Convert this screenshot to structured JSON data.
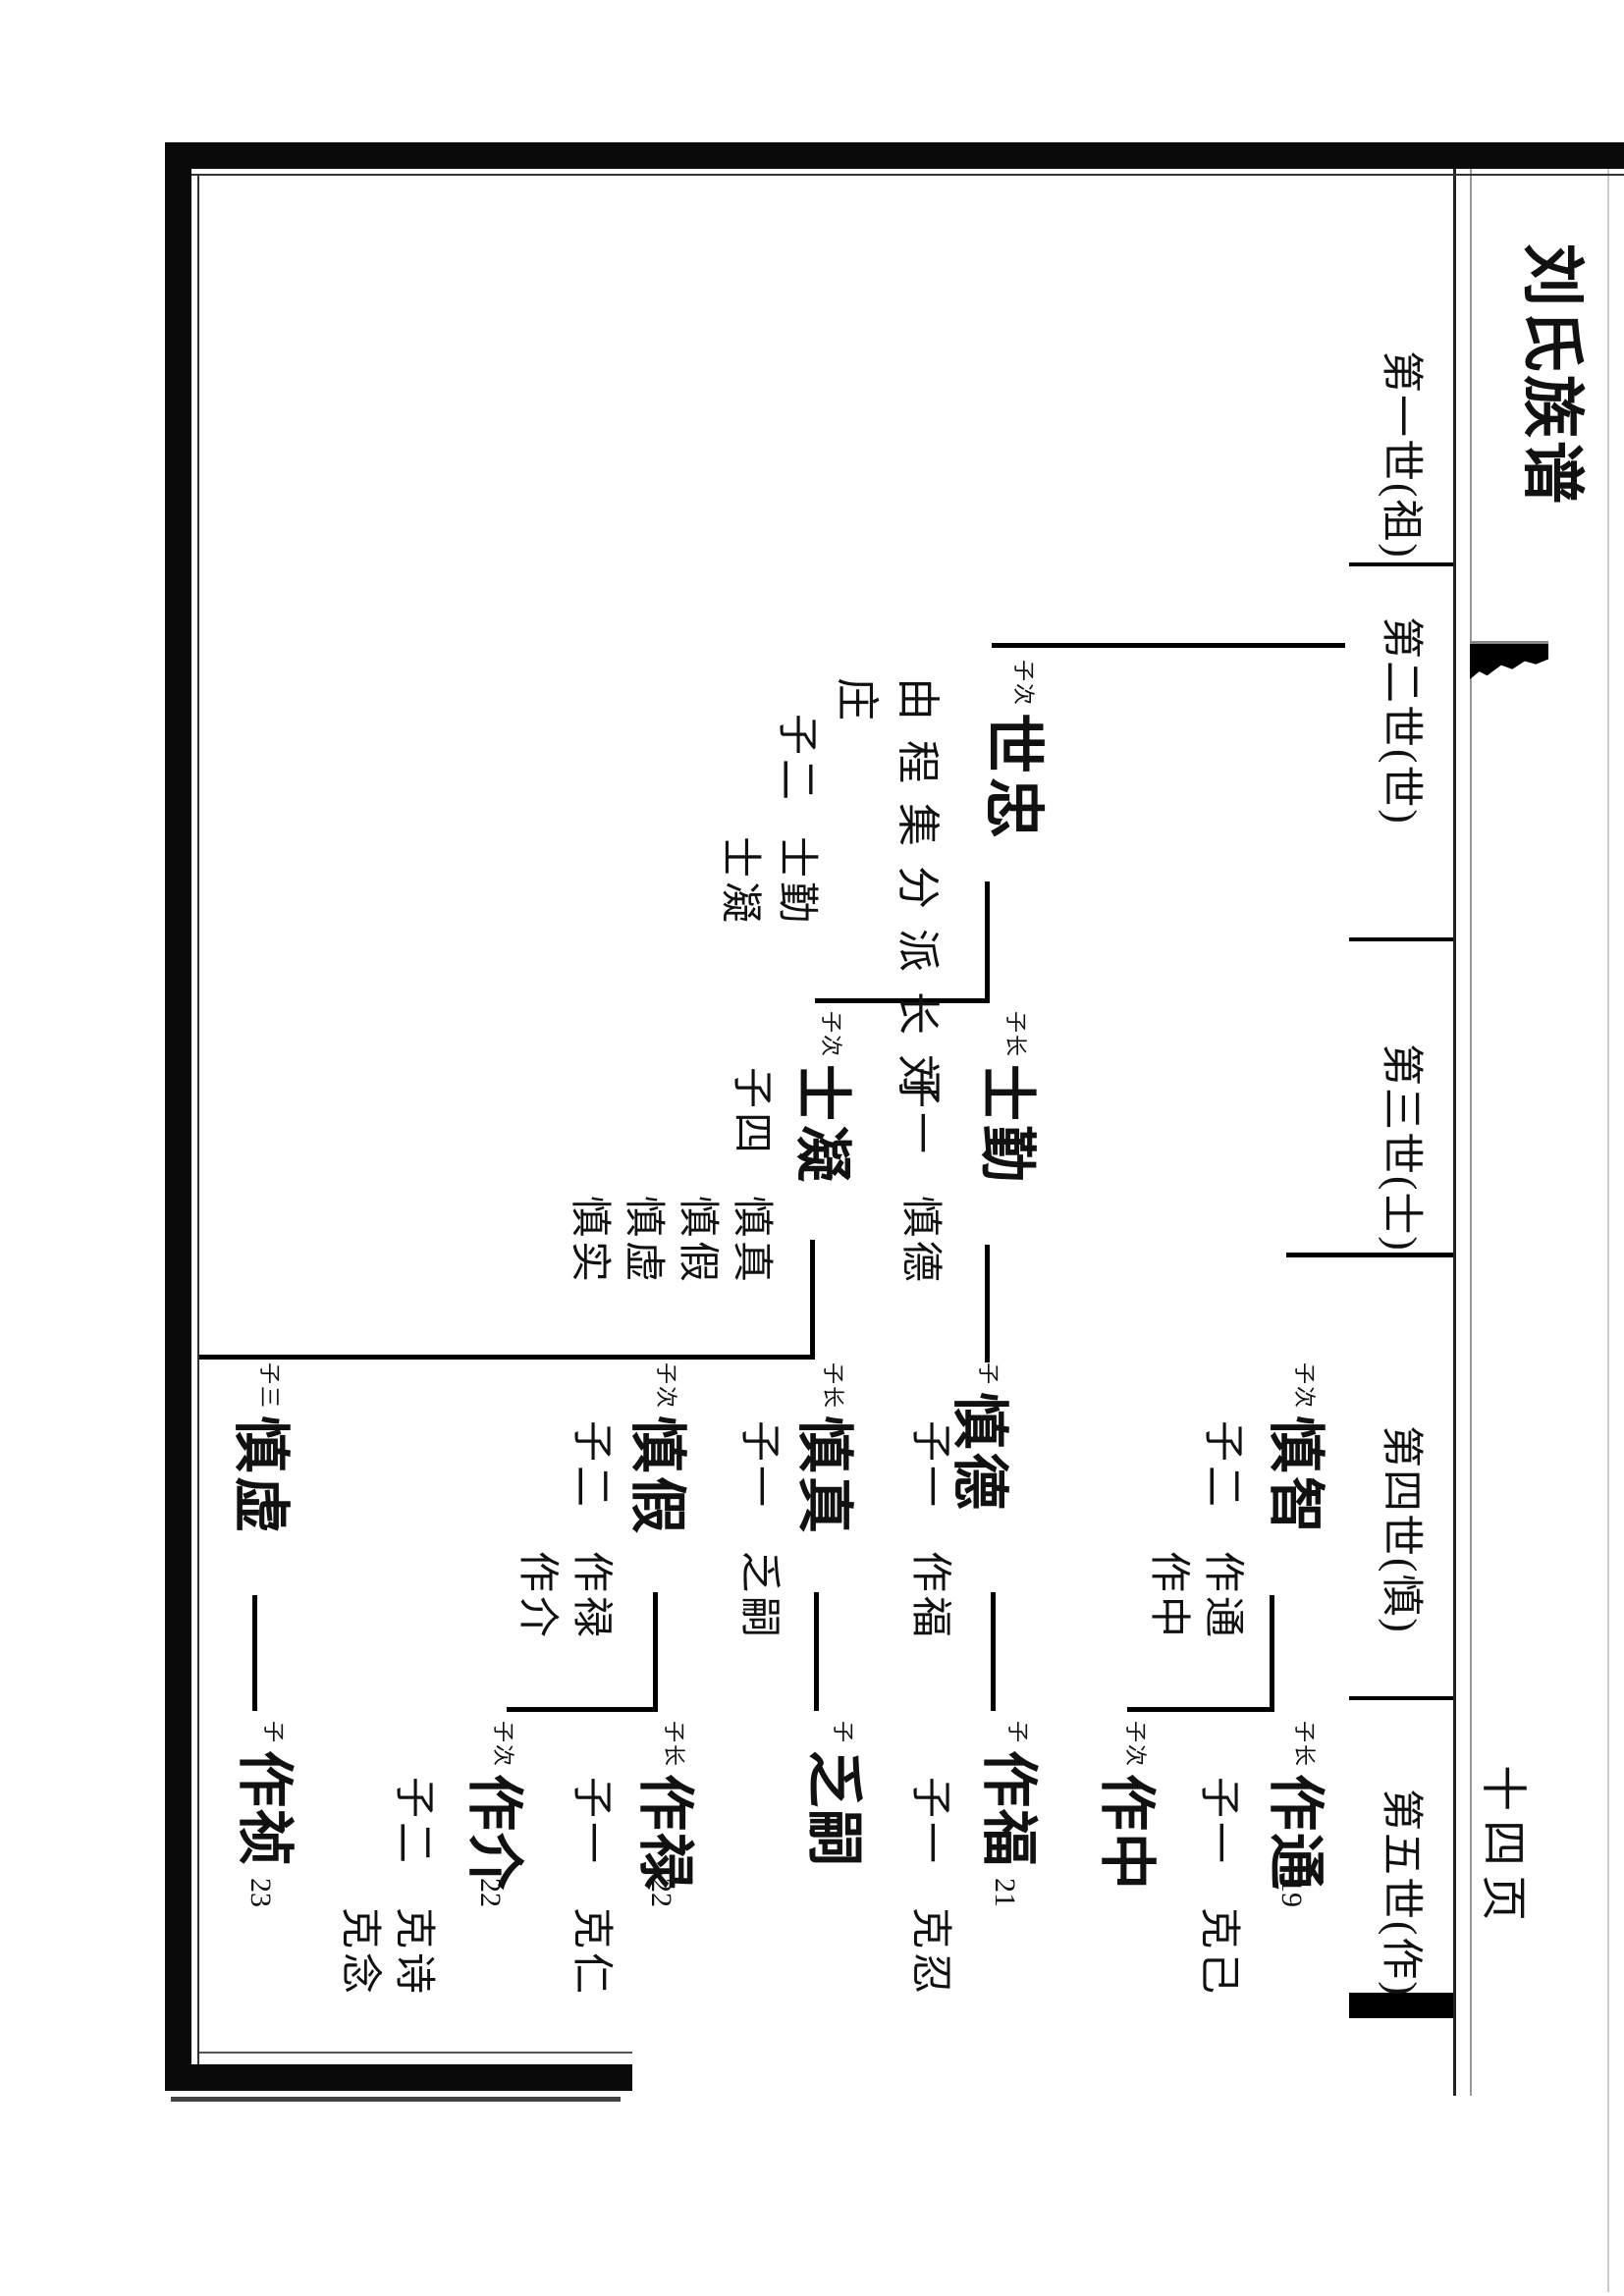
{
  "page": {
    "title": "刘氏族谱",
    "page_label": "十四页"
  },
  "headers": [
    {
      "label": "第一世(祖)"
    },
    {
      "label": "第二世(世)"
    },
    {
      "label": "第三世(士)"
    },
    {
      "label": "第四世(慎)"
    },
    {
      "label": "第五世(作)"
    }
  ],
  "tree": {
    "persons": [
      {
        "generation": 2,
        "label": "子次",
        "name": "世忠",
        "annotation_line1": "由程集分派长刘",
        "annotation_line2": "庄",
        "note_count": "子二",
        "children": [
          "士勤",
          "士凝"
        ]
      },
      {
        "generation": 3,
        "label": "子长",
        "name": "士勤",
        "note_count": "子一",
        "children": [
          "慎德"
        ]
      },
      {
        "generation": 3,
        "label": "子次",
        "name": "士凝",
        "note_count": "子四",
        "children": [
          "慎真",
          "慎假",
          "慎虚",
          "慎实"
        ]
      },
      {
        "generation": 4,
        "label": "子次",
        "name": "慎智",
        "note_count": "子二",
        "children": [
          "作通",
          "作中"
        ]
      },
      {
        "generation": 4,
        "label": "子",
        "name": "慎德",
        "note_count": "子一",
        "children": [
          "作福"
        ]
      },
      {
        "generation": 4,
        "label": "子长",
        "name": "慎真",
        "note_count": "子一",
        "children": [
          "乏嗣"
        ]
      },
      {
        "generation": 4,
        "label": "子次",
        "name": "慎假",
        "note_count": "子二",
        "children": [
          "作禄",
          "作介"
        ]
      },
      {
        "generation": 4,
        "label": "子三",
        "name": "慎虚"
      },
      {
        "generation": 5,
        "label": "子长",
        "name": "作通",
        "number": "19",
        "note_count": "子一",
        "children": [
          "克己"
        ]
      },
      {
        "generation": 5,
        "label": "子次",
        "name": "作中"
      },
      {
        "generation": 5,
        "label": "子",
        "name": "作福",
        "number": "21",
        "note_count": "子一",
        "children": [
          "克忍"
        ]
      },
      {
        "generation": 5,
        "label": "子",
        "name": "乏嗣"
      },
      {
        "generation": 5,
        "label": "子长",
        "name": "作禄",
        "number": "22",
        "note_count": "子一",
        "children": [
          "克仁"
        ]
      },
      {
        "generation": 5,
        "label": "子次",
        "name": "作介",
        "number": "22",
        "note_count": "子二",
        "children": [
          "克诗",
          "克念"
        ]
      },
      {
        "generation": 5,
        "label": "子",
        "name": "作祯",
        "number": "23"
      }
    ]
  }
}
